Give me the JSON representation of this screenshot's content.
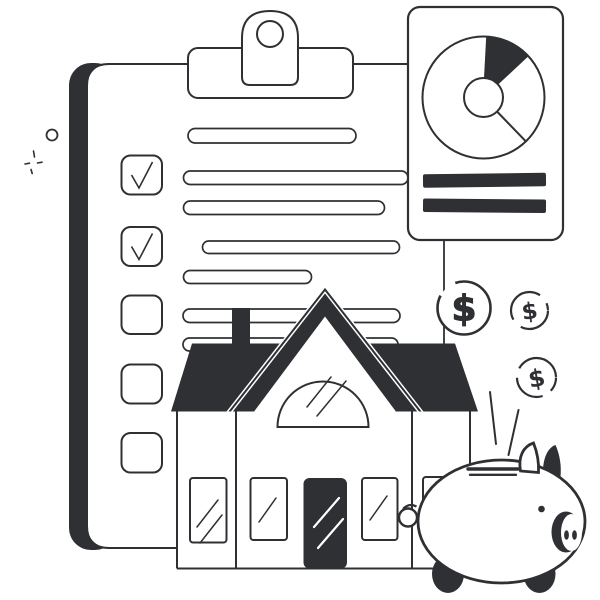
{
  "illustration": {
    "description": "Home-buying checklist illustration with clipboard, report card with donut chart, house, dollar coins and piggy bank",
    "colors": {
      "ink": "#2f3033",
      "paper": "#ffffff"
    }
  },
  "clipboard": {
    "checklist": [
      {
        "checked": true
      },
      {
        "checked": true
      },
      {
        "checked": false
      },
      {
        "checked": false
      },
      {
        "checked": false
      }
    ],
    "text_line_count": 7
  },
  "report_card": {
    "bar_count": 2
  },
  "chart_data": {
    "type": "pie",
    "title": "",
    "donut_hole": true,
    "segments": [
      {
        "label": "filled-slice",
        "value_deg": 44,
        "filled": true
      },
      {
        "label": "open-slice-small",
        "value_deg": 89,
        "filled": false
      },
      {
        "label": "open-slice-large",
        "value_deg": 227,
        "filled": false
      }
    ]
  },
  "coins": [
    {
      "symbol": "$"
    },
    {
      "symbol": "$"
    },
    {
      "symbol": "$"
    }
  ],
  "piggy_bank": {
    "present": true
  }
}
